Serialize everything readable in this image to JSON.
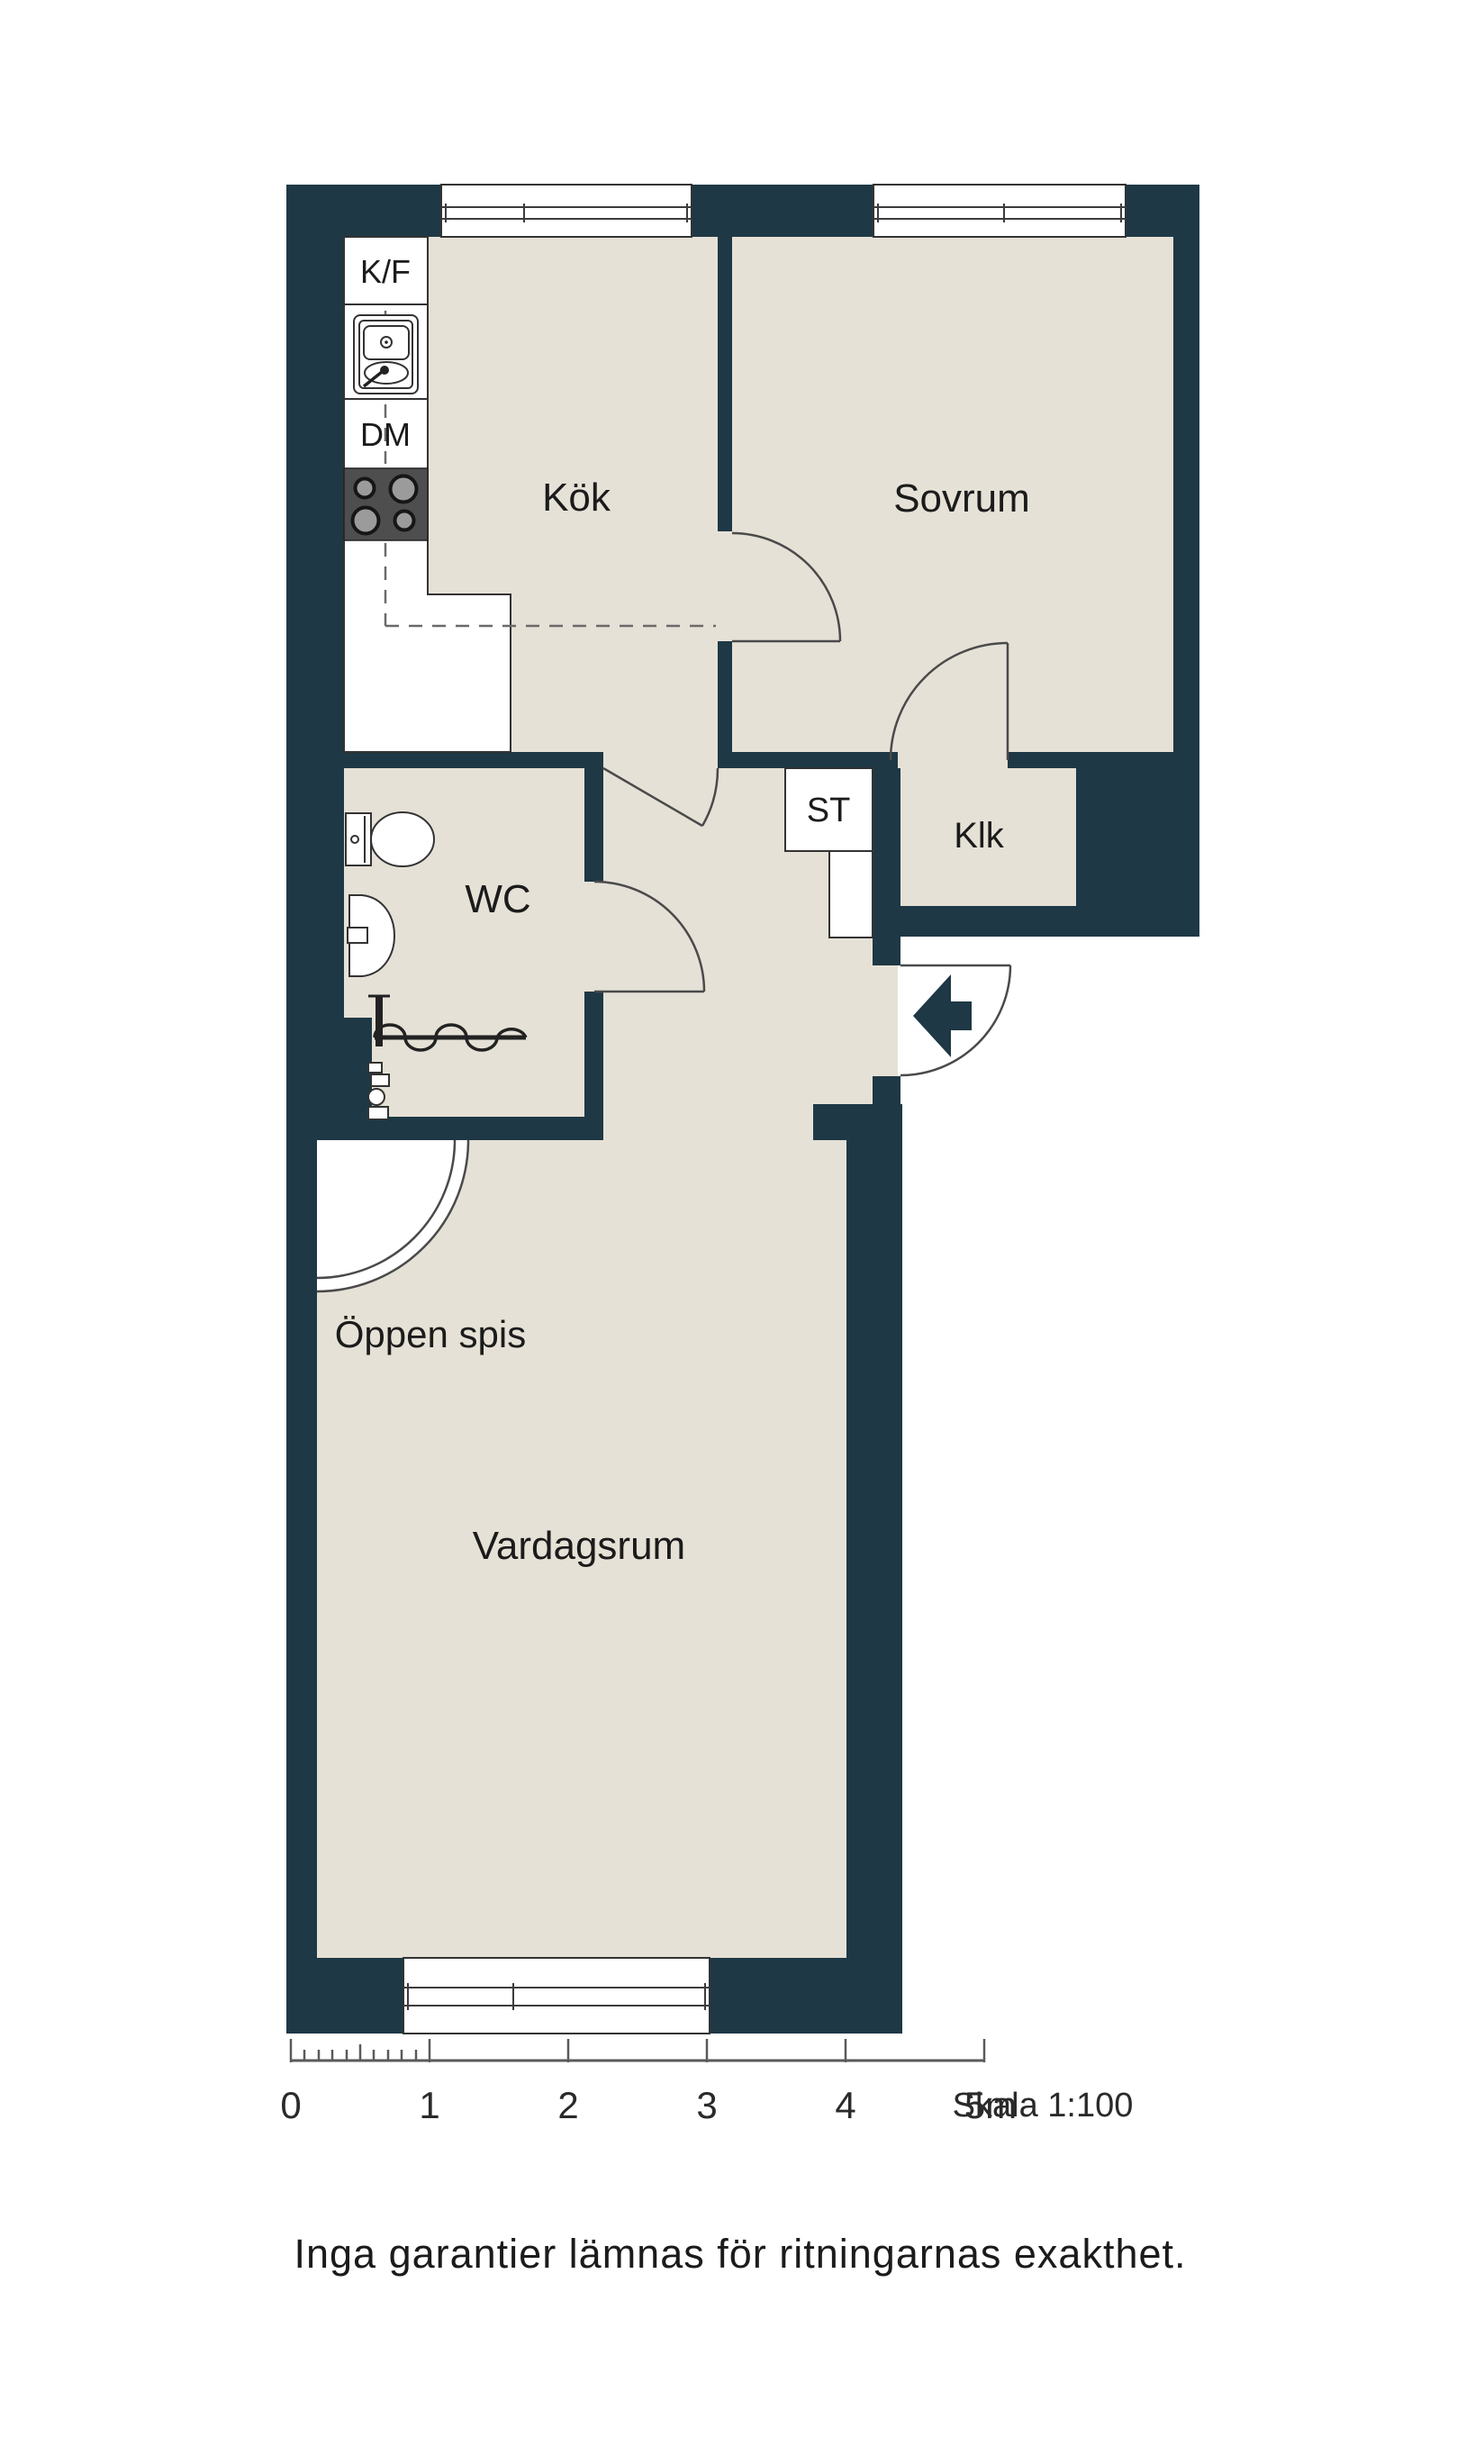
{
  "floorplan": {
    "room_labels": {
      "kitchen": "Kök",
      "bedroom": "Sovrum",
      "wc": "WC",
      "closet_st": "ST",
      "closet_klk": "Klk",
      "open_fireplace": "Öppen spis",
      "living_room": "Vardagsrum"
    },
    "appliance_labels": {
      "fridge_freezer": "K/F",
      "dishwasher": "DM"
    },
    "colors": {
      "wall": "#1e3845",
      "floor": "#e6e1d6",
      "background": "#ffffff",
      "stove": "#4e4e4e"
    }
  },
  "scale_bar": {
    "tick_labels": [
      "0",
      "1",
      "2",
      "3",
      "4",
      "5m"
    ],
    "scale_label": "Skala 1:100"
  },
  "disclaimer": "Inga garantier lämnas för ritningarnas exakthet."
}
